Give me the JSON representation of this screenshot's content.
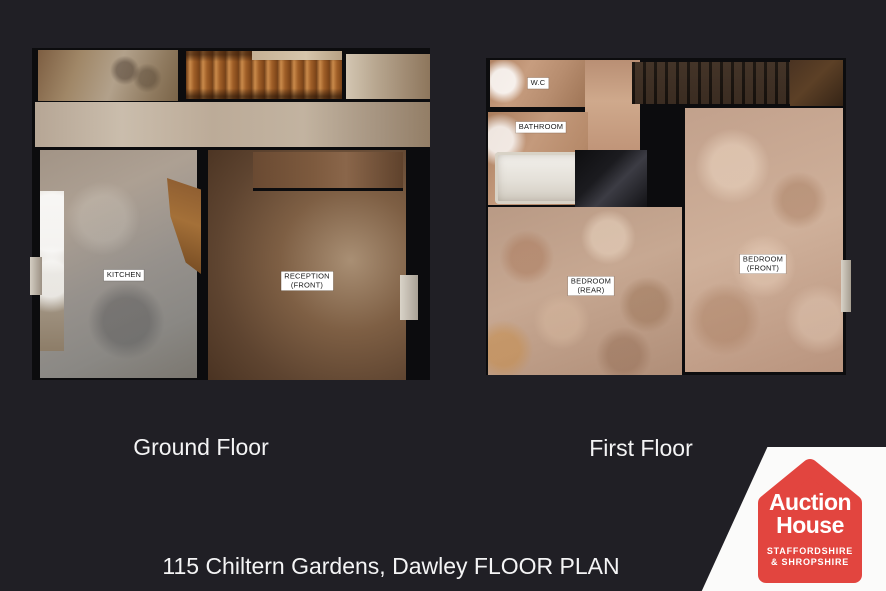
{
  "background_color": "#201f25",
  "caption": "115 Chiltern Gardens, Dawley FLOOR PLAN",
  "floors": {
    "ground": {
      "title": "Ground Floor",
      "rooms": {
        "kitchen": "KITCHEN",
        "reception_line1": "RECEPTION",
        "reception_line2": "(FRONT)"
      }
    },
    "first": {
      "title": "First Floor",
      "rooms": {
        "wc": "W.C",
        "bathroom": "BATHROOM",
        "bedroom_rear_line1": "BEDROOM",
        "bedroom_rear_line2": "(REAR)",
        "bedroom_front_line1": "BEDROOM",
        "bedroom_front_line2": "(FRONT)"
      }
    }
  },
  "logo": {
    "line1": "Auction",
    "line2": "House",
    "line3": "STAFFORDSHIRE",
    "line4": "& SHROPSHIRE",
    "house_color": "#e2453f",
    "panel_color": "#fbfbfa"
  }
}
